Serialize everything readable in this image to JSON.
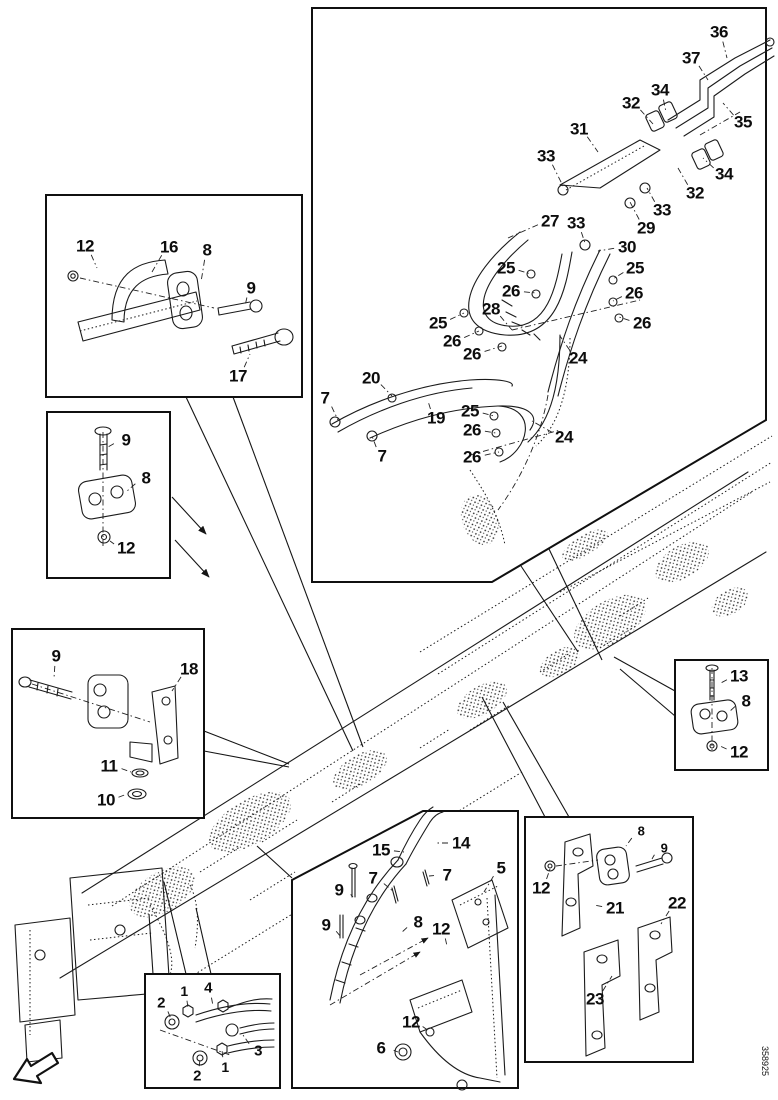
{
  "figure": {
    "id": "358925"
  },
  "colors": {
    "ink": "#1b1b1b",
    "paper": "#ffffff"
  },
  "icons": [
    {
      "name": "direction-arrow-icon",
      "meaning": "orientation arrow pointing front-left of machine"
    }
  ],
  "boxes": [
    {
      "name": "hose-routing-detail"
    },
    {
      "name": "u-bolt-clamp-detail"
    },
    {
      "name": "clamp-detail-upper"
    },
    {
      "name": "clamp-bracket-detail"
    },
    {
      "name": "clamp-detail-right"
    },
    {
      "name": "hose-guide-detail"
    },
    {
      "name": "mounting-brackets-detail"
    },
    {
      "name": "hose-fittings-detail"
    }
  ],
  "callouts": [
    {
      "box": "hose-routing-detail",
      "t": "36",
      "x": 719,
      "y": 32,
      "lx": 727,
      "ly": 58
    },
    {
      "box": "hose-routing-detail",
      "t": "37",
      "x": 691,
      "y": 58,
      "lx": 708,
      "ly": 80
    },
    {
      "box": "hose-routing-detail",
      "t": "34",
      "x": 660,
      "y": 90,
      "lx": 666,
      "ly": 112
    },
    {
      "box": "hose-routing-detail",
      "t": "32",
      "x": 631,
      "y": 103,
      "lx": 653,
      "ly": 124
    },
    {
      "box": "hose-routing-detail",
      "t": "35",
      "x": 743,
      "y": 122,
      "lx": 723,
      "ly": 103
    },
    {
      "box": "hose-routing-detail",
      "t": "31",
      "x": 579,
      "y": 129,
      "lx": 598,
      "ly": 152
    },
    {
      "box": "hose-routing-detail",
      "t": "33",
      "x": 546,
      "y": 156,
      "lx": 563,
      "ly": 186
    },
    {
      "box": "hose-routing-detail",
      "t": "34",
      "x": 724,
      "y": 174,
      "lx": 703,
      "ly": 158
    },
    {
      "box": "hose-routing-detail",
      "t": "32",
      "x": 695,
      "y": 193,
      "lx": 678,
      "ly": 168
    },
    {
      "box": "hose-routing-detail",
      "t": "33",
      "x": 662,
      "y": 210,
      "lx": 647,
      "ly": 188
    },
    {
      "box": "hose-routing-detail",
      "t": "29",
      "x": 646,
      "y": 228,
      "lx": 630,
      "ly": 202
    },
    {
      "box": "hose-routing-detail",
      "t": "27",
      "x": 550,
      "y": 221,
      "lx": 508,
      "ly": 238
    },
    {
      "box": "hose-routing-detail",
      "t": "33",
      "x": 576,
      "y": 223,
      "lx": 585,
      "ly": 243
    },
    {
      "box": "hose-routing-detail",
      "t": "30",
      "x": 627,
      "y": 247,
      "lx": 598,
      "ly": 251
    },
    {
      "box": "hose-routing-detail",
      "t": "25",
      "x": 506,
      "y": 268,
      "lx": 531,
      "ly": 274
    },
    {
      "box": "hose-routing-detail",
      "t": "25",
      "x": 635,
      "y": 268,
      "lx": 613,
      "ly": 279
    },
    {
      "box": "hose-routing-detail",
      "t": "26",
      "x": 511,
      "y": 291,
      "lx": 536,
      "ly": 293
    },
    {
      "box": "hose-routing-detail",
      "t": "26",
      "x": 634,
      "y": 293,
      "lx": 613,
      "ly": 301
    },
    {
      "box": "hose-routing-detail",
      "t": "28",
      "x": 491,
      "y": 309,
      "lx": 512,
      "ly": 330
    },
    {
      "box": "hose-routing-detail",
      "t": "26",
      "x": 642,
      "y": 323,
      "lx": 619,
      "ly": 317
    },
    {
      "box": "hose-routing-detail",
      "t": "25",
      "x": 438,
      "y": 323,
      "lx": 464,
      "ly": 313
    },
    {
      "box": "hose-routing-detail",
      "t": "26",
      "x": 452,
      "y": 341,
      "lx": 479,
      "ly": 331
    },
    {
      "box": "hose-routing-detail",
      "t": "26",
      "x": 472,
      "y": 354,
      "lx": 502,
      "ly": 346
    },
    {
      "box": "hose-routing-detail",
      "t": "24",
      "x": 578,
      "y": 358,
      "lx": 560,
      "ly": 336
    },
    {
      "box": "hose-routing-detail",
      "t": "20",
      "x": 371,
      "y": 378,
      "lx": 392,
      "ly": 396
    },
    {
      "box": "hose-routing-detail",
      "t": "7",
      "x": 325,
      "y": 398,
      "lx": 338,
      "ly": 420
    },
    {
      "box": "hose-routing-detail",
      "t": "25",
      "x": 470,
      "y": 411,
      "lx": 494,
      "ly": 416
    },
    {
      "box": "hose-routing-detail",
      "t": "19",
      "x": 436,
      "y": 418,
      "lx": 428,
      "ly": 401
    },
    {
      "box": "hose-routing-detail",
      "t": "26",
      "x": 472,
      "y": 430,
      "lx": 496,
      "ly": 433
    },
    {
      "box": "hose-routing-detail",
      "t": "24",
      "x": 564,
      "y": 437,
      "lx": 532,
      "ly": 421
    },
    {
      "box": "hose-routing-detail",
      "t": "7",
      "x": 382,
      "y": 456,
      "lx": 372,
      "ly": 436
    },
    {
      "box": "hose-routing-detail",
      "t": "26",
      "x": 472,
      "y": 457,
      "lx": 499,
      "ly": 452
    },
    {
      "box": "u-bolt-clamp-detail",
      "t": "12",
      "x": 85,
      "y": 246,
      "lx": 97,
      "ly": 268
    },
    {
      "box": "u-bolt-clamp-detail",
      "t": "16",
      "x": 169,
      "y": 247,
      "lx": 152,
      "ly": 272
    },
    {
      "box": "u-bolt-clamp-detail",
      "t": "8",
      "x": 207,
      "y": 250,
      "lx": 201,
      "ly": 282
    },
    {
      "box": "u-bolt-clamp-detail",
      "t": "9",
      "x": 251,
      "y": 288,
      "lx": 245,
      "ly": 306
    },
    {
      "box": "u-bolt-clamp-detail",
      "t": "17",
      "x": 238,
      "y": 376,
      "lx": 250,
      "ly": 354
    },
    {
      "box": "clamp-detail-upper",
      "t": "9",
      "x": 126,
      "y": 440,
      "lx": 108,
      "ly": 447
    },
    {
      "box": "clamp-detail-upper",
      "t": "8",
      "x": 146,
      "y": 478,
      "lx": 126,
      "ly": 492
    },
    {
      "box": "clamp-detail-upper",
      "t": "12",
      "x": 126,
      "y": 548,
      "lx": 110,
      "ly": 541
    },
    {
      "box": "clamp-bracket-detail",
      "t": "9",
      "x": 56,
      "y": 656,
      "lx": 54,
      "ly": 678
    },
    {
      "box": "clamp-bracket-detail",
      "t": "18",
      "x": 189,
      "y": 669,
      "lx": 172,
      "ly": 691
    },
    {
      "box": "clamp-bracket-detail",
      "t": "11",
      "x": 109,
      "y": 766,
      "lx": 131,
      "ly": 772
    },
    {
      "box": "clamp-bracket-detail",
      "t": "10",
      "x": 106,
      "y": 800,
      "lx": 127,
      "ly": 794
    },
    {
      "box": "clamp-detail-right",
      "t": "13",
      "x": 739,
      "y": 676,
      "lx": 719,
      "ly": 684
    },
    {
      "box": "clamp-detail-right",
      "t": "8",
      "x": 746,
      "y": 701,
      "lx": 729,
      "ly": 712
    },
    {
      "box": "clamp-detail-right",
      "t": "12",
      "x": 739,
      "y": 752,
      "lx": 720,
      "ly": 746
    },
    {
      "box": "hose-guide-detail",
      "t": "15",
      "x": 381,
      "y": 850,
      "lx": 404,
      "ly": 852
    },
    {
      "box": "hose-guide-detail",
      "t": "14",
      "x": 461,
      "y": 843,
      "lx": 436,
      "ly": 843
    },
    {
      "box": "hose-guide-detail",
      "t": "7",
      "x": 373,
      "y": 878,
      "lx": 394,
      "ly": 892
    },
    {
      "box": "hose-guide-detail",
      "t": "7",
      "x": 447,
      "y": 875,
      "lx": 429,
      "ly": 876
    },
    {
      "box": "hose-guide-detail",
      "t": "5",
      "x": 501,
      "y": 868,
      "lx": 484,
      "ly": 892
    },
    {
      "box": "hose-guide-detail",
      "t": "9",
      "x": 339,
      "y": 890,
      "lx": 353,
      "ly": 897
    },
    {
      "box": "hose-guide-detail",
      "t": "9",
      "x": 326,
      "y": 925,
      "lx": 341,
      "ly": 937
    },
    {
      "box": "hose-guide-detail",
      "t": "8",
      "x": 418,
      "y": 922,
      "lx": 401,
      "ly": 933
    },
    {
      "box": "hose-guide-detail",
      "t": "12",
      "x": 441,
      "y": 929,
      "lx": 447,
      "ly": 946
    },
    {
      "box": "hose-guide-detail",
      "t": "12",
      "x": 411,
      "y": 1022,
      "lx": 429,
      "ly": 1031
    },
    {
      "box": "hose-guide-detail",
      "t": "6",
      "x": 381,
      "y": 1048,
      "lx": 398,
      "ly": 1052
    },
    {
      "box": "mounting-brackets-detail",
      "t": "8",
      "x": 641,
      "y": 831,
      "s": 13,
      "lx": 626,
      "ly": 846
    },
    {
      "box": "mounting-brackets-detail",
      "t": "9",
      "x": 664,
      "y": 848,
      "s": 13,
      "lx": 652,
      "ly": 859
    },
    {
      "box": "mounting-brackets-detail",
      "t": "12",
      "x": 541,
      "y": 888,
      "lx": 550,
      "ly": 869
    },
    {
      "box": "mounting-brackets-detail",
      "t": "21",
      "x": 615,
      "y": 908,
      "lx": 594,
      "ly": 905
    },
    {
      "box": "mounting-brackets-detail",
      "t": "22",
      "x": 677,
      "y": 903,
      "lx": 661,
      "ly": 924
    },
    {
      "box": "mounting-brackets-detail",
      "t": "23",
      "x": 595,
      "y": 999,
      "lx": 612,
      "ly": 976
    },
    {
      "box": "hose-fittings-detail",
      "t": "2",
      "x": 161,
      "y": 1003,
      "s": 15,
      "lx": 171,
      "ly": 1019
    },
    {
      "box": "hose-fittings-detail",
      "t": "1",
      "x": 184,
      "y": 991,
      "s": 14,
      "lx": 188,
      "ly": 1008
    },
    {
      "box": "hose-fittings-detail",
      "t": "4",
      "x": 208,
      "y": 988,
      "s": 15,
      "lx": 213,
      "ly": 1006
    },
    {
      "box": "hose-fittings-detail",
      "t": "3",
      "x": 258,
      "y": 1051,
      "s": 15,
      "lx": 243,
      "ly": 1035
    },
    {
      "box": "hose-fittings-detail",
      "t": "2",
      "x": 197,
      "y": 1076,
      "s": 15,
      "lx": 200,
      "ly": 1059
    },
    {
      "box": "hose-fittings-detail",
      "t": "1",
      "x": 225,
      "y": 1067,
      "s": 14,
      "lx": 222,
      "ly": 1050
    }
  ]
}
